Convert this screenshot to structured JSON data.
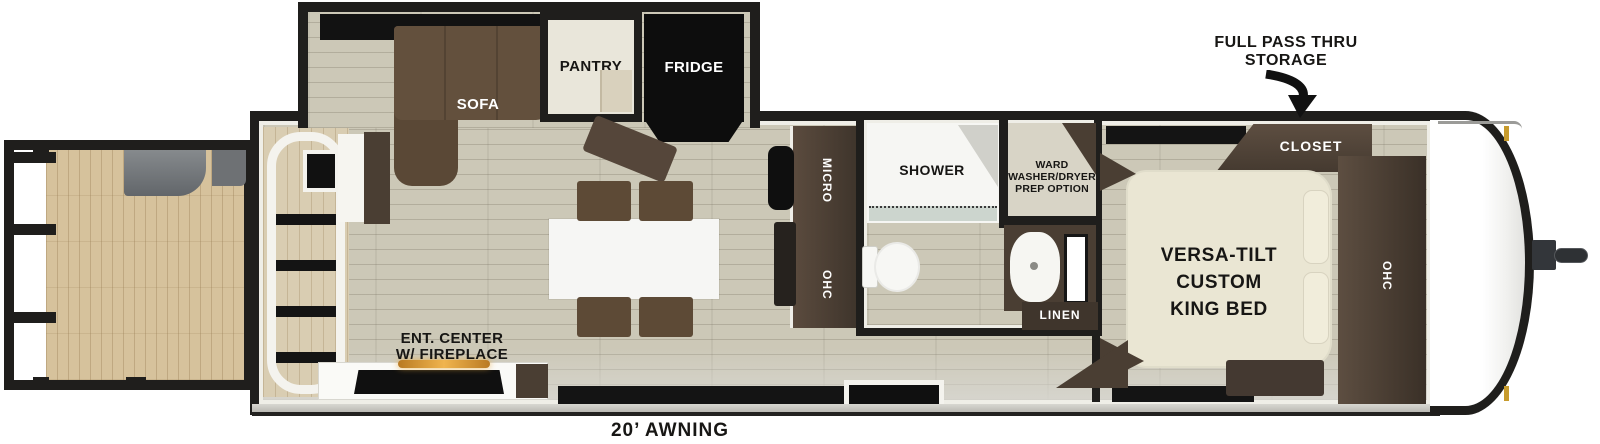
{
  "floorplan": {
    "labels": {
      "sofa": "SOFA",
      "pantry": "PANTRY",
      "fridge": "FRIDGE",
      "micro": "MICRO",
      "kitchen_ohc": "OHC",
      "shower": "SHOWER",
      "ward": {
        "line1": "WARD",
        "line2": "WASHER/DRYER",
        "line3": "PREP OPTION"
      },
      "linen": "LINEN",
      "closet": "CLOSET",
      "king_bed": {
        "line1": "VERSA-TILT",
        "line2": "CUSTOM",
        "line3": "KING BED"
      },
      "bedroom_ohc": "OHC",
      "ent_center": {
        "line1": "ENT. CENTER",
        "line2": "W/ FIREPLACE"
      },
      "pass_thru": {
        "line1": "FULL PASS THRU",
        "line2": "STORAGE"
      },
      "awning": "20’ AWNING"
    },
    "colors": {
      "wall": "#1f1e1c",
      "interior_floor": "#ccc8b7",
      "deck_floor": "#d6c29c",
      "dark_wood": "#4a3e33",
      "sofa": "#63503d",
      "bed": "#eae6d3",
      "fridge": "#0d0d0d",
      "fireplace_glow": "#f0b44e",
      "marker_light": "#c79b2d"
    }
  }
}
